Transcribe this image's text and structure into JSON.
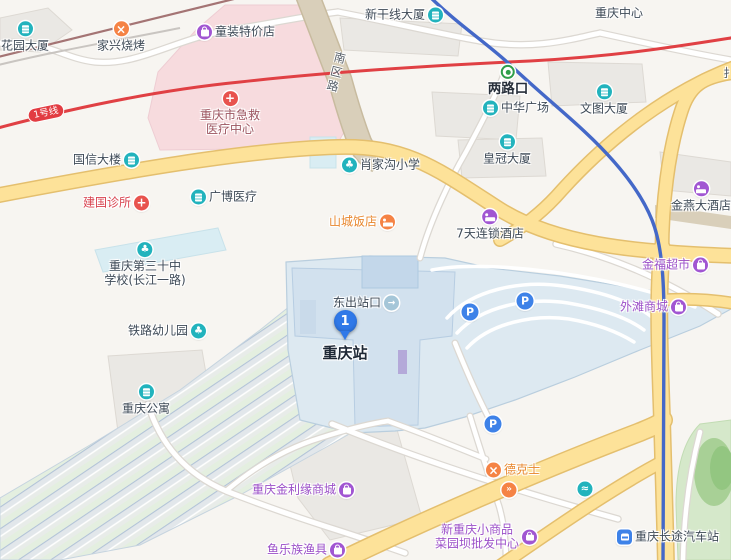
{
  "map": {
    "marker": {
      "number": "1",
      "x": 345,
      "y": 345
    },
    "line_badge": {
      "text": "1号线",
      "x": 46,
      "y": 113,
      "rotation": -12
    },
    "road_labels": [
      {
        "text": "南区路",
        "x": 336,
        "y": 73,
        "vertical": true,
        "rotation": 14
      },
      {
        "text": "扌",
        "x": 729,
        "y": 73,
        "vertical": false,
        "rotation": 0
      }
    ],
    "pois": [
      {
        "lines": [
          "花园大厦"
        ],
        "x": 25,
        "y": 37,
        "icon": "building",
        "iconColor": "teal",
        "side": "top",
        "style": "dark"
      },
      {
        "lines": [
          "家兴烧烤"
        ],
        "x": 121,
        "y": 37,
        "icon": "restaurant",
        "iconColor": "orange",
        "side": "top",
        "style": "dark"
      },
      {
        "lines": [
          "童装特价店"
        ],
        "x": 236,
        "y": 32,
        "icon": "bag",
        "iconColor": "purple",
        "side": "left",
        "style": "dark"
      },
      {
        "lines": [
          "重庆市急救",
          "医疗中心"
        ],
        "x": 230,
        "y": 114,
        "icon": "hospital",
        "iconColor": "red",
        "side": "top",
        "style": "maroon"
      },
      {
        "lines": [
          "国信大楼"
        ],
        "x": 106,
        "y": 160,
        "icon": "building",
        "iconColor": "teal",
        "side": "right",
        "style": "dark"
      },
      {
        "lines": [
          "建国诊所"
        ],
        "x": 116,
        "y": 203,
        "icon": "hospital",
        "iconColor": "red",
        "side": "right",
        "style": "red"
      },
      {
        "lines": [
          "广博医疗"
        ],
        "x": 224,
        "y": 197,
        "icon": "building",
        "iconColor": "teal",
        "side": "left",
        "style": "dark"
      },
      {
        "lines": [
          "重庆第三十中",
          "学校(长江一路)"
        ],
        "x": 145,
        "y": 265,
        "icon": "school",
        "iconColor": "teal",
        "side": "top",
        "style": "dark"
      },
      {
        "lines": [
          "铁路幼儿园"
        ],
        "x": 167,
        "y": 331,
        "icon": "school",
        "iconColor": "teal",
        "side": "right",
        "style": "dark"
      },
      {
        "lines": [
          "重庆公寓"
        ],
        "x": 146,
        "y": 400,
        "icon": "building",
        "iconColor": "teal",
        "side": "top",
        "style": "dark"
      },
      {
        "lines": [
          "肖家沟小学"
        ],
        "x": 381,
        "y": 165,
        "icon": "school",
        "iconColor": "teal",
        "side": "left",
        "style": "dark"
      },
      {
        "lines": [
          "山城饭店"
        ],
        "x": 362,
        "y": 222,
        "icon": "bed",
        "iconColor": "orange",
        "side": "right",
        "style": "orange"
      },
      {
        "lines": [
          "新干线大厦"
        ],
        "x": 404,
        "y": 15,
        "icon": "building",
        "iconColor": "teal",
        "side": "right",
        "style": "dark"
      },
      {
        "lines": [
          "两路口"
        ],
        "x": 508,
        "y": 81,
        "icon": "metro",
        "iconColor": "green",
        "side": "top",
        "style": "bold"
      },
      {
        "lines": [
          "中华广场"
        ],
        "x": 516,
        "y": 108,
        "icon": "building",
        "iconColor": "teal",
        "side": "left",
        "style": "dark"
      },
      {
        "lines": [
          "皇冠大厦"
        ],
        "x": 507,
        "y": 150,
        "icon": "building",
        "iconColor": "teal",
        "side": "top",
        "style": "dark"
      },
      {
        "lines": [
          "重庆中心"
        ],
        "x": 619,
        "y": 13,
        "icon": "none",
        "side": "none",
        "style": "dark"
      },
      {
        "lines": [
          "文图大厦"
        ],
        "x": 604,
        "y": 100,
        "icon": "building",
        "iconColor": "teal",
        "side": "top",
        "style": "dark"
      },
      {
        "lines": [
          "7天连锁酒店"
        ],
        "x": 490,
        "y": 225,
        "icon": "bed",
        "iconColor": "purple",
        "side": "top",
        "style": "dark"
      },
      {
        "lines": [
          "金燕大酒店"
        ],
        "x": 701,
        "y": 197,
        "icon": "bed",
        "iconColor": "purple",
        "side": "top",
        "style": "dark"
      },
      {
        "lines": [
          "金福超市"
        ],
        "x": 675,
        "y": 265,
        "icon": "bag",
        "iconColor": "purple",
        "side": "right",
        "style": "purple"
      },
      {
        "lines": [
          "外滩商城"
        ],
        "x": 653,
        "y": 307,
        "icon": "bag",
        "iconColor": "purple",
        "side": "right",
        "style": "purple"
      },
      {
        "lines": [
          "东出站口"
        ],
        "x": 366,
        "y": 303,
        "icon": "exit",
        "iconColor": "pale",
        "side": "right",
        "style": "dark"
      },
      {
        "lines": [
          "重庆站"
        ],
        "x": 345,
        "y": 353,
        "icon": "none",
        "side": "none",
        "style": "title"
      },
      {
        "lines": [
          "德克士"
        ],
        "x": 513,
        "y": 470,
        "icon": "restaurant",
        "iconColor": "orange",
        "side": "left",
        "style": "orange"
      },
      {
        "lines": [
          "重庆金利缘商城"
        ],
        "x": 303,
        "y": 490,
        "icon": "bag",
        "iconColor": "purple",
        "side": "right",
        "style": "purple"
      },
      {
        "lines": [
          "鱼乐族渔具"
        ],
        "x": 306,
        "y": 550,
        "icon": "bag",
        "iconColor": "purple",
        "side": "right",
        "style": "purple"
      },
      {
        "lines": [
          "新重庆小商品",
          "菜园坝批发中心"
        ],
        "x": 486,
        "y": 537,
        "icon": "bag",
        "iconColor": "purple",
        "side": "right",
        "style": "purple"
      },
      {
        "lines": [
          "重庆长途汽车站"
        ],
        "x": 668,
        "y": 537,
        "icon": "bus",
        "iconColor": "blue",
        "side": "left",
        "style": "dark"
      },
      {
        "lines": [],
        "x": 470,
        "y": 312,
        "icon": "parking",
        "iconColor": "blue",
        "side": "left",
        "style": "dark"
      },
      {
        "lines": [],
        "x": 525,
        "y": 301,
        "icon": "parking",
        "iconColor": "blue",
        "side": "left",
        "style": "dark"
      },
      {
        "lines": [],
        "x": 493,
        "y": 424,
        "icon": "parking",
        "iconColor": "blue",
        "side": "left",
        "style": "dark"
      },
      {
        "lines": [],
        "x": 585,
        "y": 489,
        "icon": "wave",
        "iconColor": "teal",
        "side": "left",
        "style": "dark"
      },
      {
        "lines": [],
        "x": 509,
        "y": 490,
        "icon": "arrows",
        "iconColor": "orange",
        "side": "left",
        "style": "dark"
      }
    ]
  }
}
